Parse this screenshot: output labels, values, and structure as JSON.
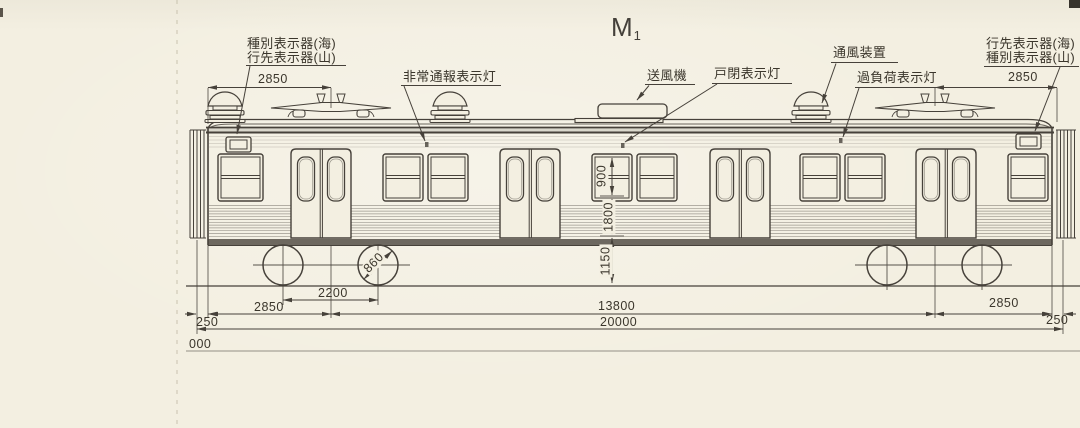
{
  "title": {
    "label": "M",
    "subscript": "1"
  },
  "callouts": {
    "left_destination": {
      "line1": "種別表示器(海)",
      "line2": "行先表示器(山)"
    },
    "emergency_alarm": "非常通報表示灯",
    "blower": "送風機",
    "door_closed": "戸閉表示灯",
    "ventilator": "通風装置",
    "overload": "過負荷表示灯",
    "right_destination": {
      "line1": "行先表示器(海)",
      "line2": "種別表示器(山)"
    }
  },
  "dimensions": {
    "top_left_span": "2850",
    "top_right_span": "2850",
    "window_height": "900",
    "body_height": "1800",
    "floor_height": "1150",
    "axle_spacing": "2200",
    "wheel_diameter": "860",
    "left_overhang": "2850",
    "right_overhang": "2850",
    "bogie_centers": "13800",
    "overall_length": "20000",
    "left_end": "250",
    "right_end": "250",
    "datum": "000"
  },
  "colors": {
    "paper": "#f3efe1",
    "ink": "#46413a"
  }
}
